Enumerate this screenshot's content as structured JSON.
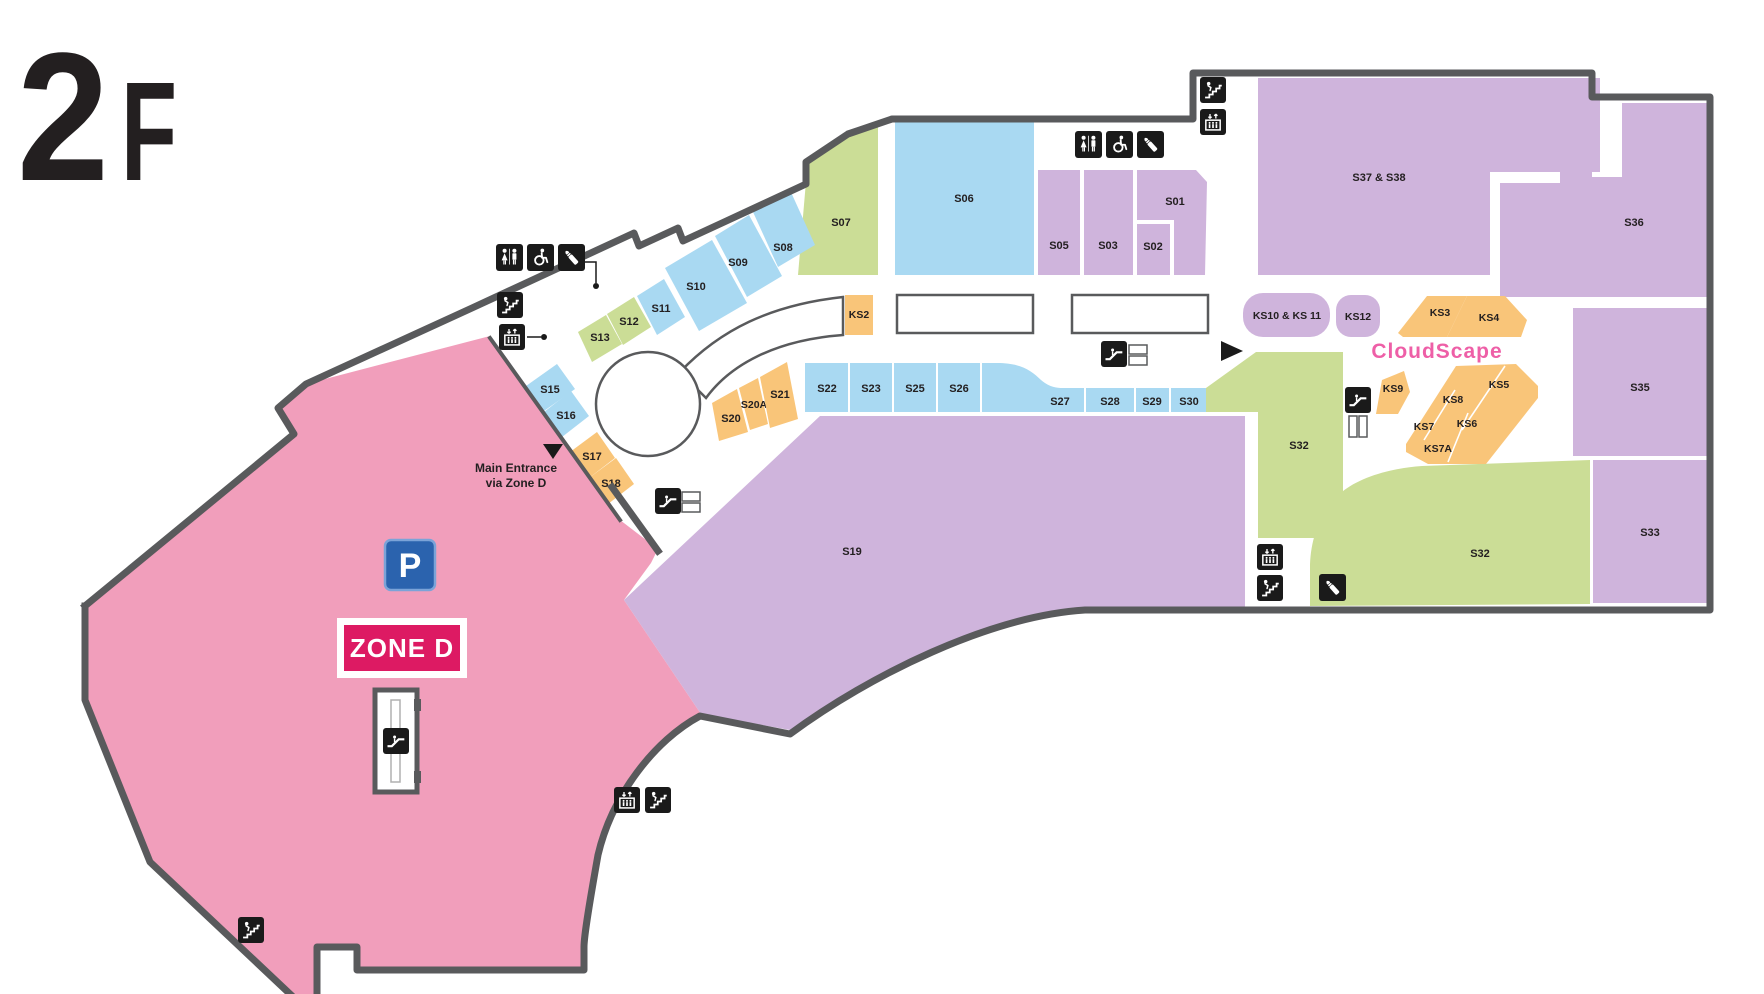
{
  "floor": {
    "number": "2",
    "suffix": "F"
  },
  "zone_d": {
    "label": "ZONE D",
    "parking": "P"
  },
  "markers": {
    "entrance_line1": "Main Entrance",
    "entrance_line2": "via Zone D"
  },
  "branding": {
    "kiosk_area": "CloudScape"
  },
  "stores": {
    "s01": "S01",
    "s02": "S02",
    "s03": "S03",
    "s05": "S05",
    "s06": "S06",
    "s07": "S07",
    "s08": "S08",
    "s09": "S09",
    "s10": "S10",
    "s11": "S11",
    "s12": "S12",
    "s13": "S13",
    "s15": "S15",
    "s16": "S16",
    "s17": "S17",
    "s18": "S18",
    "s19": "S19",
    "s20": "S20",
    "s20a": "S20A",
    "s21": "S21",
    "s22": "S22",
    "s23": "S23",
    "s25": "S25",
    "s26": "S26",
    "s27": "S27",
    "s28": "S28",
    "s29": "S29",
    "s30": "S30",
    "s32_left": "S32",
    "s32_right": "S32",
    "s33": "S33",
    "s35": "S35",
    "s36": "S36",
    "s37_38": "S37 & S38"
  },
  "kiosks": {
    "ks2": "KS2",
    "ks3": "KS3",
    "ks4": "KS4",
    "ks5": "KS5",
    "ks6": "KS6",
    "ks7": "KS7",
    "ks7a": "KS7A",
    "ks8": "KS8",
    "ks9": "KS9",
    "ks10_11": "KS10 & KS 11",
    "ks12": "KS12"
  },
  "icons": {
    "restroom": "restroom-icon",
    "accessible": "wheelchair-accessible-icon",
    "nursing": "nursing-room-icon",
    "stairs": "stairs-icon",
    "elevator": "elevator-icon",
    "escalator": "escalator-icon",
    "parking": "parking-sign",
    "entrance_arrow": "entrance-arrow"
  },
  "colors": {
    "zone_d_fill": "#F19EBB",
    "zone_d_badge": "#DD1A63",
    "parking_blue": "#2B63AE",
    "purple_store": "#CFB4DC",
    "blue_store": "#A9D9F2",
    "green_store": "#CBDD96",
    "orange_kiosk": "#F9C579",
    "wall_gray": "#595A5C",
    "cloudscape_pink": "#EE5FA7",
    "icon_black": "#1A1A1A"
  }
}
